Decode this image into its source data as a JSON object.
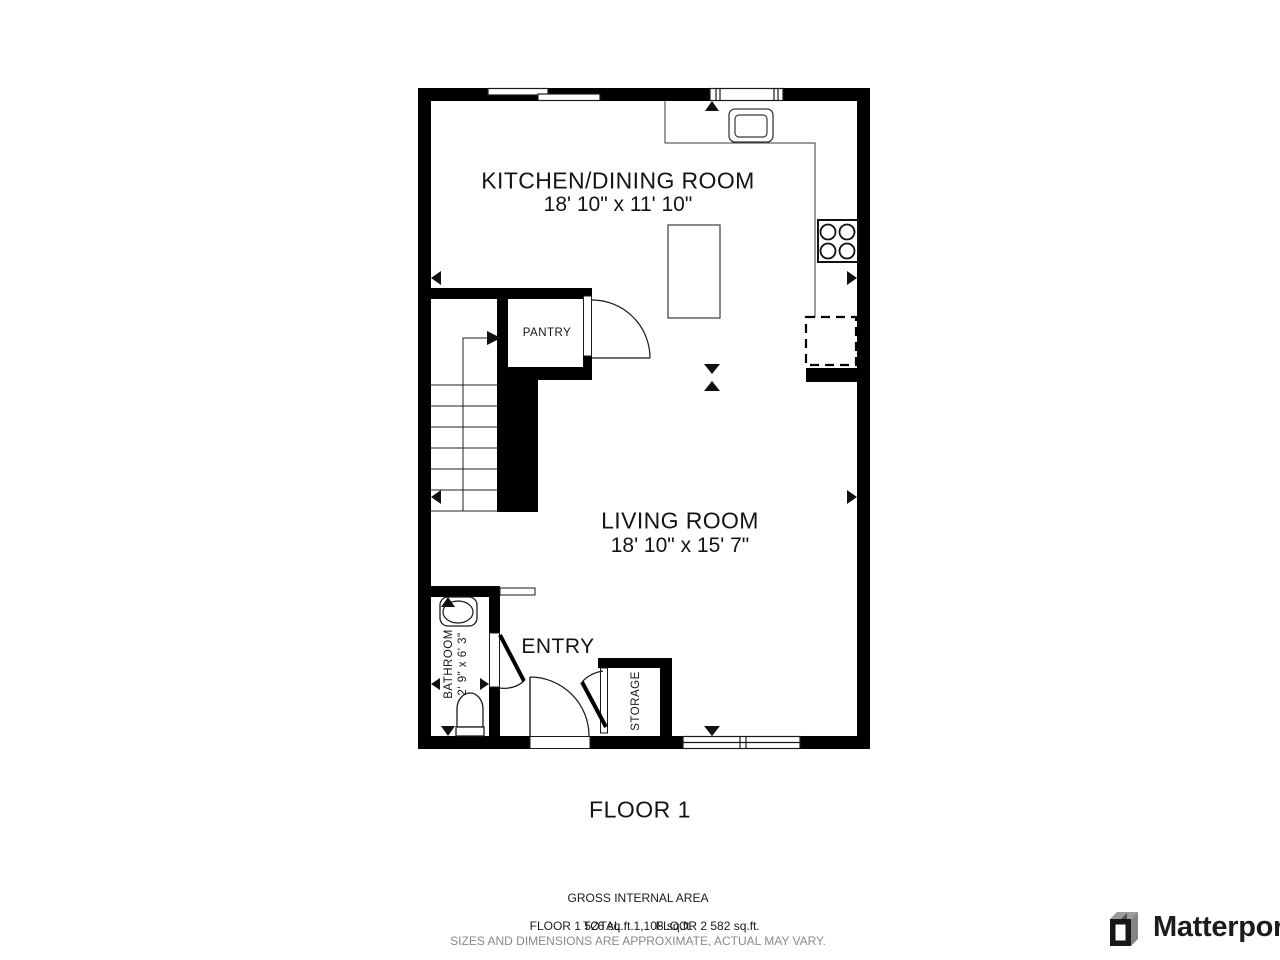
{
  "rooms": {
    "kitchen": {
      "label": "KITCHEN/DINING ROOM",
      "dims": "18' 10\" x 11' 10\""
    },
    "living": {
      "label": "LIVING ROOM",
      "dims": "18' 10\" x 15' 7\""
    },
    "pantry": {
      "label": "PANTRY"
    },
    "entry": {
      "label": "ENTRY"
    },
    "storage": {
      "label": "STORAGE"
    },
    "bathroom": {
      "label": "BATHROOM",
      "dims": "2' 9\" x 6' 3\""
    }
  },
  "floor": {
    "label": "FLOOR 1"
  },
  "footer": {
    "title": "GROSS INTERNAL AREA",
    "floor1_area": "FLOOR 1 526 sq.ft.",
    "floor2_area": "FLOOR 2 582 sq.ft.",
    "total": "TOTAL :  1,108 sq.ft.",
    "disclaimer": "SIZES AND DIMENSIONS ARE APPROXIMATE, ACTUAL MAY VARY."
  },
  "branding": {
    "name": "Matterport"
  },
  "colors": {
    "wall": "#000000",
    "line": "#1a1a1a",
    "muted_text": "#8a8a8a"
  }
}
